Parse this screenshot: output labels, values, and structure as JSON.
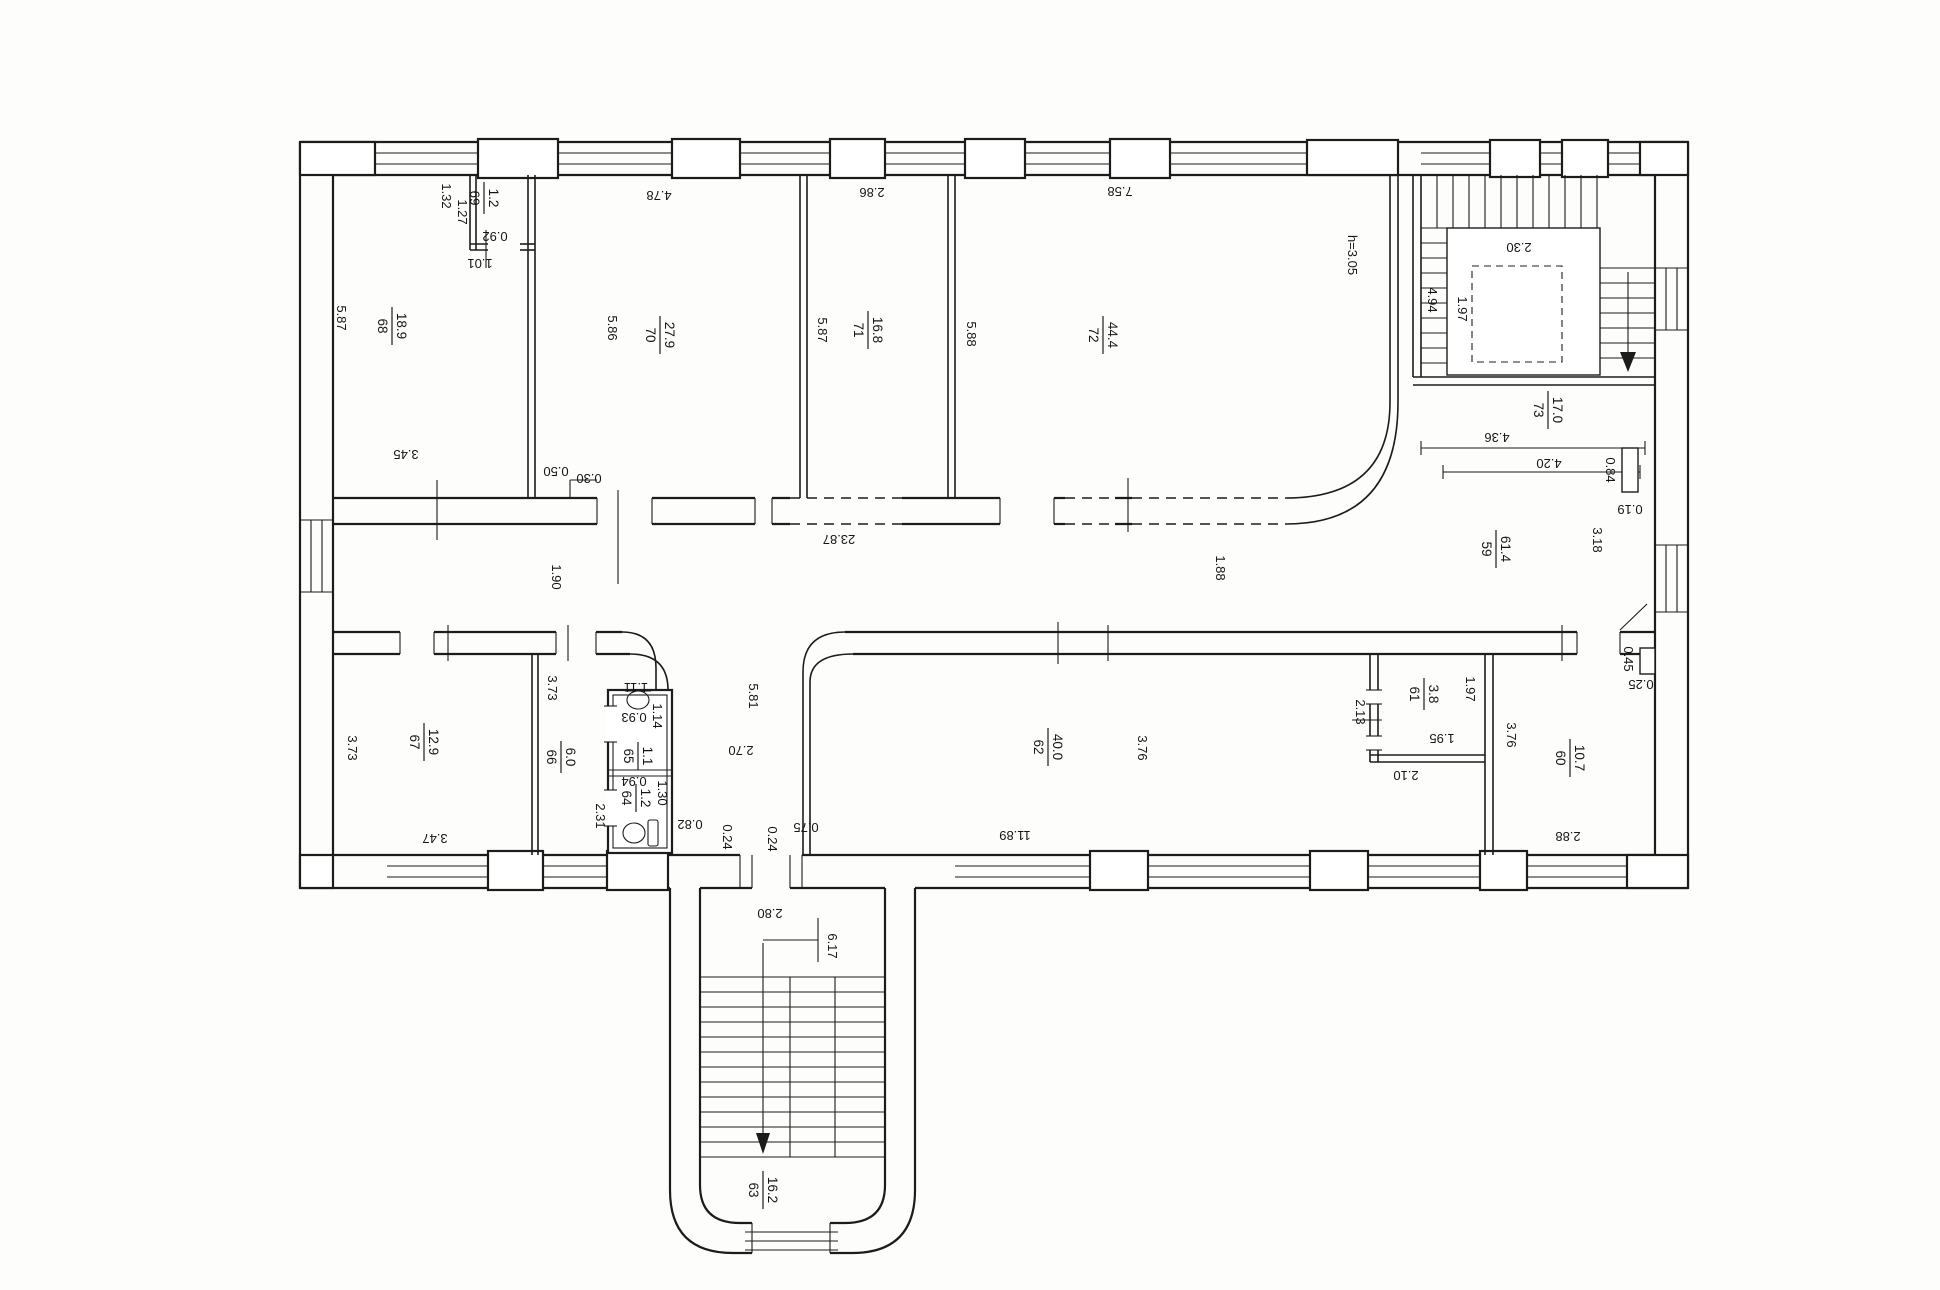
{
  "document": {
    "type": "floor-plan scan",
    "height_note": "h=3.05",
    "colors": {
      "line": "#1c1c1c",
      "paper": "#fdfdfc"
    }
  },
  "icons": {
    "sink": "sink-icon",
    "toilet": "toilet-icon",
    "stair_arrow": "stair-down-arrow"
  },
  "rooms": {
    "r59": {
      "num": "59",
      "area": "61.4"
    },
    "r60": {
      "num": "60",
      "area": "10.7"
    },
    "r61": {
      "num": "61",
      "area": "3.8"
    },
    "r62": {
      "num": "62",
      "area": "40.0"
    },
    "r63": {
      "num": "63",
      "area": "16.2"
    },
    "r64": {
      "num": "64",
      "area": "1.2"
    },
    "r65": {
      "num": "65",
      "area": "1.1"
    },
    "r66": {
      "num": "66",
      "area": "6.0"
    },
    "r67": {
      "num": "67",
      "area": "12.9"
    },
    "r68": {
      "num": "68",
      "area": "18.9"
    },
    "r69": {
      "num": "69",
      "area": "1.2"
    },
    "r70": {
      "num": "70",
      "area": "27.9"
    },
    "r71": {
      "num": "71",
      "area": "16.8"
    },
    "r72": {
      "num": "72",
      "area": "44.4"
    },
    "r73": {
      "num": "73",
      "area": "17.0"
    }
  },
  "dims": {
    "r68_depth": "5.87",
    "r68_width": "3.45",
    "c69_w": "1.32",
    "c69_d": "1.27",
    "c69_door": "0.92",
    "c69_open": "1.01",
    "jamb_a": "0.50",
    "jamb_b": "0.30",
    "r70_depth": "5.86",
    "r70_width": "4.78",
    "r71_depth": "5.87",
    "r71_width": "2.86",
    "r72_depth": "5.88",
    "r72_width": "7.58",
    "ceiling": "h=3.05",
    "st_flight_w": "2.30",
    "st_depth": "4.94",
    "st_half": "1.97",
    "h73_w1": "4.36",
    "h73_w2": "4.20",
    "h73_stub": "0.84",
    "h73_thk": "0.19",
    "cor_w_left": "1.90",
    "cor_len": "23.87",
    "cor_w_mid": "1.88",
    "cor_w_right": "3.18",
    "r67_depth": "3.73",
    "r67_width": "3.47",
    "r66_depth": "3.73",
    "r66_width": "2.31",
    "wc65_door": "1.11",
    "wc65_d": "0.93",
    "wc65_w": "1.14",
    "wc64_w": "0.94",
    "wc64_len": "1.30",
    "lob_gap": "0.82",
    "lob_w": "2.70",
    "lob_len": "5.81",
    "op_jamb1": "0.24",
    "op_jamb2": "0.24",
    "op_w": "0.75",
    "r62_len": "11.89",
    "r62_depth": "3.76",
    "r61_w": "2.13",
    "r61_d": "1.97",
    "r61_iw": "1.95",
    "r61_id": "2.10",
    "r60_depth": "3.76",
    "r60_width": "2.88",
    "r60_stub": "0.45",
    "r60_thk": "0.25",
    "st63_w": "2.80",
    "st63_len": "6.17"
  }
}
